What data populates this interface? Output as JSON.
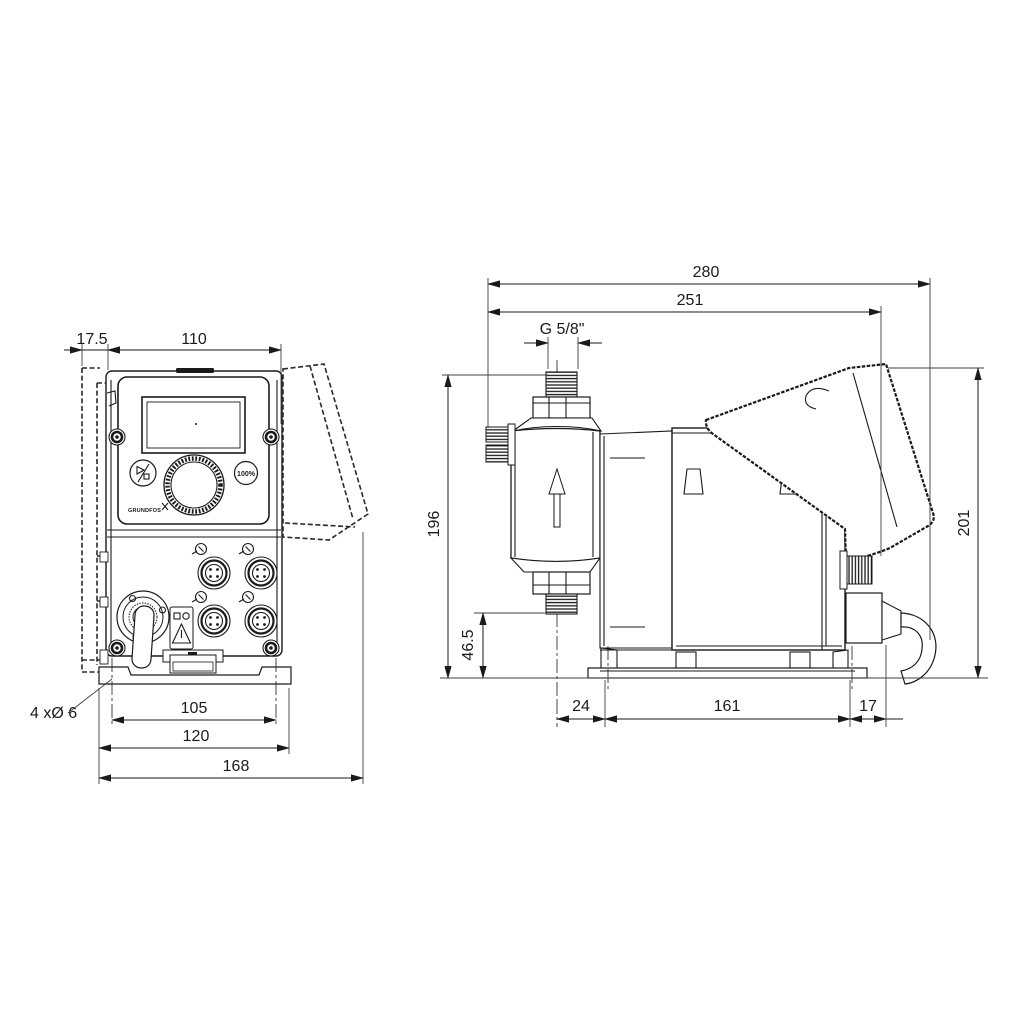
{
  "drawing_title": "Dosing pump dimensional drawing",
  "front_view": {
    "dim_offset": "17.5",
    "dim_width_top": "110",
    "dim_holes_label": "4 xØ 6",
    "dim_hole_spacing": "105",
    "dim_base_width": "120",
    "dim_overall_width": "168",
    "panel": {
      "percent_button_label": "100%",
      "brand_label": "GRUNDFOS"
    }
  },
  "side_view": {
    "dim_overall_depth": "280",
    "dim_depth_to_gland": "251",
    "dim_thread": "G 5/8\"",
    "dim_height_inlet": "196",
    "dim_height_outlet": "46.5",
    "dim_head_offset": "24",
    "dim_base_depth": "161",
    "dim_gland_offset": "17",
    "dim_overall_height": "201"
  }
}
